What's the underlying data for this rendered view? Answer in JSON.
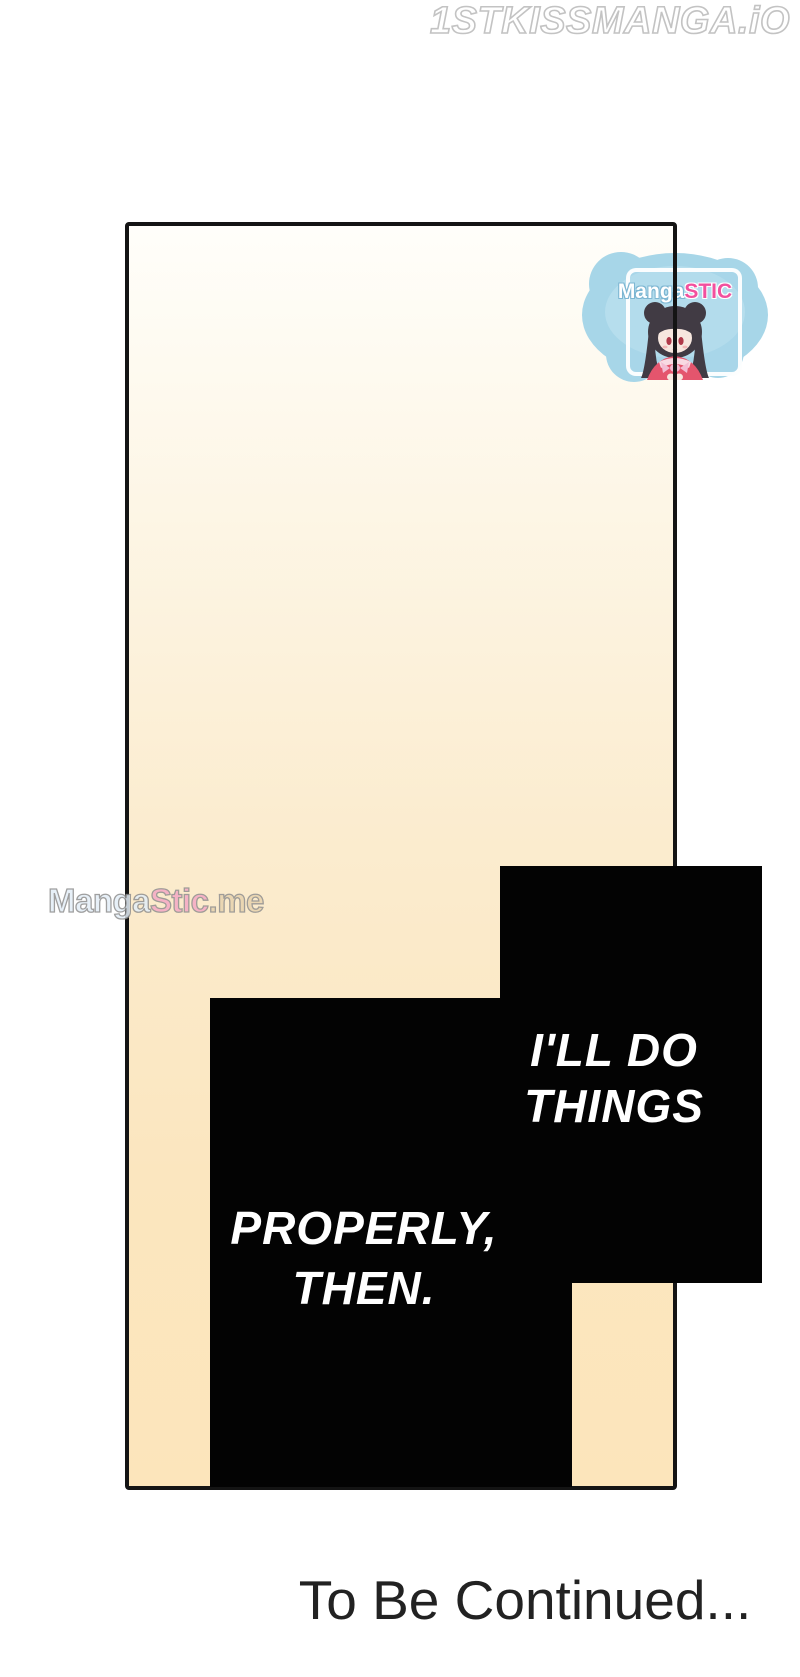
{
  "page": {
    "watermark_top": "1STKISSMANGA.iO",
    "to_be_continued": "To Be Continued...",
    "background_color": "#ffffff"
  },
  "panel": {
    "border_color": "#141414",
    "background_top_color": "#fffefa",
    "background_bottom_color": "#fce5bb"
  },
  "badge": {
    "logo_part1": "Manga",
    "logo_part2": "STIC",
    "blob_color": "#a7d6e8",
    "logo_part2_color": "#f2509e",
    "icon": "anime-girl-icon"
  },
  "watermark_left": {
    "part1": "Manga",
    "part2": "Stic",
    "part3": ".me",
    "part1_color": "#e3eef7",
    "part2_color": "#f4a9c4",
    "part3_color": "#e8d3ae"
  },
  "speech_right": {
    "line1": "I'LL DO",
    "line2": "THINGS",
    "text_color": "#ffffff",
    "bubble_color": "#030303"
  },
  "speech_left": {
    "line1": "PROPERLY,",
    "line2": "THEN."
  }
}
